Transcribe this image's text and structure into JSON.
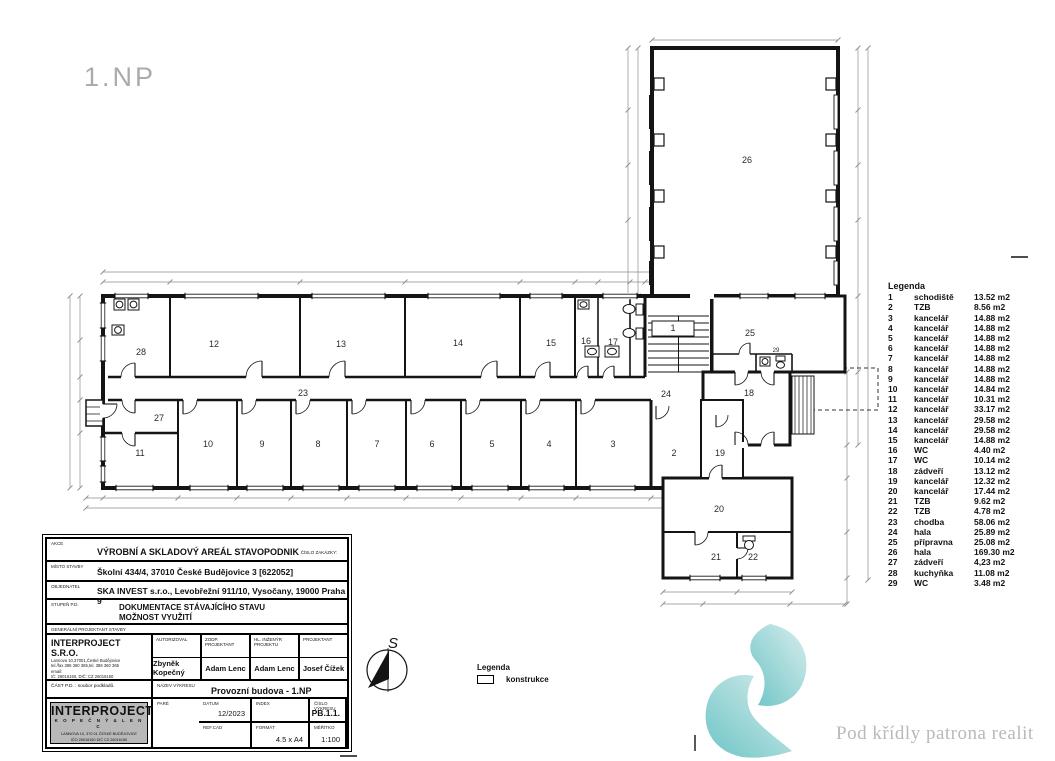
{
  "page": {
    "title": "1.NP"
  },
  "legend": {
    "title": "Legenda",
    "rows": [
      {
        "num": "1",
        "name": "schodiště",
        "area": "13.52 m2"
      },
      {
        "num": "2",
        "name": "TZB",
        "area": "8.56 m2"
      },
      {
        "num": "3",
        "name": "kancelář",
        "area": "14.88 m2"
      },
      {
        "num": "4",
        "name": "kancelář",
        "area": "14.88 m2"
      },
      {
        "num": "5",
        "name": "kancelář",
        "area": "14.88 m2"
      },
      {
        "num": "6",
        "name": "kancelář",
        "area": "14.88 m2"
      },
      {
        "num": "7",
        "name": "kancelář",
        "area": "14.88 m2"
      },
      {
        "num": "8",
        "name": "kancelář",
        "area": "14.88 m2"
      },
      {
        "num": "9",
        "name": "kancelář",
        "area": "14.88 m2"
      },
      {
        "num": "10",
        "name": "kancelář",
        "area": "14.84 m2"
      },
      {
        "num": "11",
        "name": "kancelář",
        "area": "10.31 m2"
      },
      {
        "num": "12",
        "name": "kancelář",
        "area": "33.17 m2"
      },
      {
        "num": "13",
        "name": "kancelář",
        "area": "29.58 m2"
      },
      {
        "num": "14",
        "name": "kancelář",
        "area": "29.58 m2"
      },
      {
        "num": "15",
        "name": "kancelář",
        "area": "14.88 m2"
      },
      {
        "num": "16",
        "name": "WC",
        "area": "4.40 m2"
      },
      {
        "num": "17",
        "name": "WC",
        "area": "10.14 m2"
      },
      {
        "num": "18",
        "name": "zádveří",
        "area": "13.12 m2"
      },
      {
        "num": "19",
        "name": "kancelář",
        "area": "12.32 m2"
      },
      {
        "num": "20",
        "name": "kancelář",
        "area": "17.44 m2"
      },
      {
        "num": "21",
        "name": "TZB",
        "area": "9.62 m2"
      },
      {
        "num": "22",
        "name": "TZB",
        "area": "4.78 m2"
      },
      {
        "num": "23",
        "name": "chodba",
        "area": "58.06 m2"
      },
      {
        "num": "24",
        "name": "hala",
        "area": "25.89 m2"
      },
      {
        "num": "25",
        "name": "přípravna",
        "area": "25.08 m2"
      },
      {
        "num": "26",
        "name": "hala",
        "area": "169.30 m2"
      },
      {
        "num": "27",
        "name": "zádveří",
        "area": "4,23 m2"
      },
      {
        "num": "28",
        "name": "kuchyňka",
        "area": "11.08 m2"
      },
      {
        "num": "29",
        "name": "WC",
        "area": "3.48 m2"
      }
    ]
  },
  "construction_legend": {
    "title": "Legenda",
    "item": "konstrukce"
  },
  "north_arrow": {
    "label": "S"
  },
  "title_block": {
    "akce_label": "AKCE",
    "akce": "VÝROBNÍ A SKLADOVÝ AREÁL STAVOPODNIK",
    "cislo_zakazky_label": "ČÍSLO ZAKÁZKY:",
    "misto_label": "MÍSTO STAVBY",
    "misto": "Školní 434/4, 37010 České Budějovice 3 [622052]",
    "objednatel_label": "OBJEDNATEL",
    "objednatel": "SKA INVEST s.r.o., Levobřežní 911/10, Vysočany, 19000 Praha 9",
    "stupen_label": "STUPEŇ P.D.",
    "stupen_line1": "DOKUMENTACE STÁVAJÍCÍHO STAVU",
    "stupen_line2": "MOŽNOST VYUŽITÍ",
    "gen_projektant_label": "GENERÁLNÍ PROJEKTANT STAVBY",
    "company": {
      "name": "INTERPROJECT S.R.O.",
      "address": "Lannova 10,37001,České Budějovice",
      "phone": "tel./fax 386 360 365,tel. 386 360 365",
      "email": "email:",
      "ic": "IČ: 26016150, DIČ: CZ 26016150"
    },
    "cols": [
      {
        "label": "AUTORIZOVAL",
        "value": "Zbyněk Kopečný"
      },
      {
        "label": "ZODP. PROJEKTANT",
        "value": "Adam Lenc"
      },
      {
        "label": "HL. INŽENÝR PROJEKTU",
        "value": "Adam Lenc"
      },
      {
        "label": "PROJEKTANT",
        "value": "Josef Čížek"
      }
    ],
    "cast_pd": "ČÁST P.D. : soubor podkladů.",
    "nazev_label": "NÁZEV VÝKRESU",
    "nazev": "Provozní budova - 1.NP",
    "logo": {
      "line1": "INTERPROJECT",
      "line2": "K O P E Č N Ý   &   L E N C",
      "line3": "LANNOVA 10, 370 01 ČESKÉ BUDĚJOVICE",
      "line4": "IČO 26016150    DIČ CZ 26016150"
    },
    "fields": {
      "datum_label": "DATUM",
      "datum": "12/2023",
      "index_label": "INDEX",
      "index": "",
      "cislo_vykresu_label": "ČÍSLO VÝKRESU",
      "cislo_vykresu": "PB.1.1.",
      "pare_label": "PARÉ",
      "pare": "",
      "refcad_label": "REF.CAD",
      "refcad": "",
      "format_label": "FORMÁT",
      "format": "4.5 x A4",
      "meritko_label": "MĚŘÍTKO",
      "meritko": "1:100"
    }
  },
  "watermark": {
    "text": "Pod křídly patrona realit",
    "teal": "#6cc3c4",
    "teal_light": "#d2ebe9",
    "text_color": "#b7baba"
  },
  "plan": {
    "room_labels": [
      {
        "label": "28",
        "x": 141,
        "y": 355
      },
      {
        "label": "12",
        "x": 214,
        "y": 347
      },
      {
        "label": "13",
        "x": 341,
        "y": 347
      },
      {
        "label": "14",
        "x": 458,
        "y": 346
      },
      {
        "label": "15",
        "x": 551,
        "y": 346
      },
      {
        "label": "16",
        "x": 586,
        "y": 344
      },
      {
        "label": "17",
        "x": 613,
        "y": 345
      },
      {
        "label": "1",
        "x": 673,
        "y": 331
      },
      {
        "label": "23",
        "x": 303,
        "y": 396
      },
      {
        "label": "27",
        "x": 159,
        "y": 421
      },
      {
        "label": "11",
        "x": 140,
        "y": 456
      },
      {
        "label": "10",
        "x": 208,
        "y": 447
      },
      {
        "label": "9",
        "x": 262,
        "y": 447
      },
      {
        "label": "8",
        "x": 318,
        "y": 447
      },
      {
        "label": "7",
        "x": 377,
        "y": 447
      },
      {
        "label": "6",
        "x": 432,
        "y": 447
      },
      {
        "label": "5",
        "x": 492,
        "y": 447
      },
      {
        "label": "4",
        "x": 549,
        "y": 447
      },
      {
        "label": "3",
        "x": 613,
        "y": 447
      },
      {
        "label": "2",
        "x": 674,
        "y": 456
      },
      {
        "label": "19",
        "x": 720,
        "y": 456
      },
      {
        "label": "24",
        "x": 666,
        "y": 397
      },
      {
        "label": "18",
        "x": 749,
        "y": 396
      },
      {
        "label": "25",
        "x": 750,
        "y": 336
      },
      {
        "label": "26",
        "x": 747,
        "y": 163
      },
      {
        "label": "20",
        "x": 719,
        "y": 512
      },
      {
        "label": "21",
        "x": 716,
        "y": 560
      },
      {
        "label": "22",
        "x": 753,
        "y": 560
      },
      {
        "label": "29",
        "x": 776,
        "y": 352,
        "s": 6
      }
    ]
  },
  "colors": {
    "ink": "#141414",
    "dim": "#8d8d8d",
    "label": "#2a2a2a",
    "title_gray": "#ababab"
  }
}
